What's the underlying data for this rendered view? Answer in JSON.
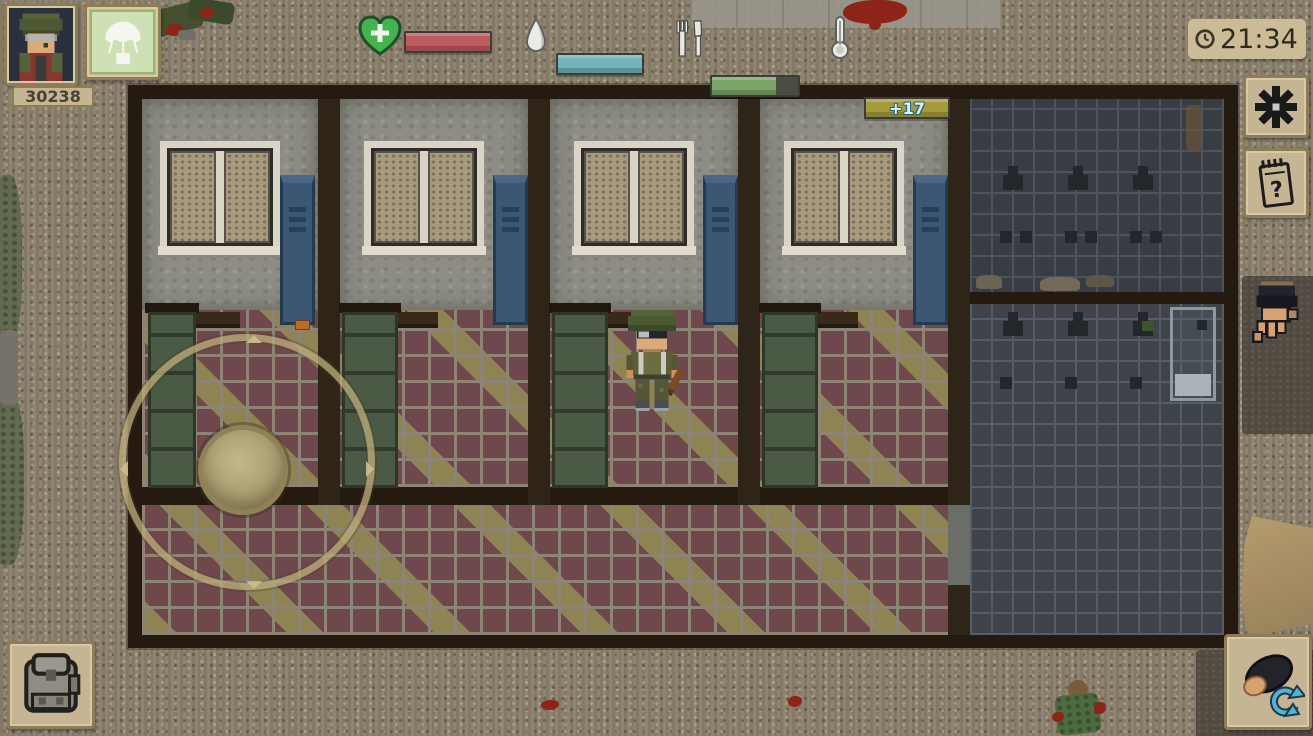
{
  "hud": {
    "player_badge": {
      "score": "30238"
    },
    "bars": {
      "health": {
        "fill_pct": 100,
        "color": "#bf5a60"
      },
      "water": {
        "fill_pct": 100,
        "color": "#72b4b9"
      },
      "food": {
        "fill_pct": 74,
        "color": "#79a566"
      },
      "temperature": {
        "fill_pct": 100,
        "color": "#a59b3c",
        "value": "+17",
        "value_color": "#d6f2fa"
      }
    },
    "clock": {
      "time": "21:34"
    },
    "icons": {
      "health": "green-heart-with-cross",
      "water": "water-droplet",
      "food": "fork-and-knife",
      "temperature": "thermometer",
      "clock": "analog-clock",
      "airdrop": "parachute",
      "actions": "black-asterisk",
      "survival_guide": "spiral-notepad-question-mark",
      "interact": "reaching-hand",
      "inventory": "backpack",
      "character": "top-down-player-head-with-rotate-arrows",
      "joystick": "ring-and-knob"
    }
  },
  "scene": {
    "building": {
      "dorm_rooms": 4,
      "windows": 4,
      "blue_lockers": 4,
      "green_doors": 4,
      "shower_room": {
        "shower_heads_upper": 3,
        "shower_heads_lower": 3,
        "bathtub": 1
      }
    },
    "player": "soldier-with-helmet-holding-club",
    "dead_bodies": 2
  }
}
